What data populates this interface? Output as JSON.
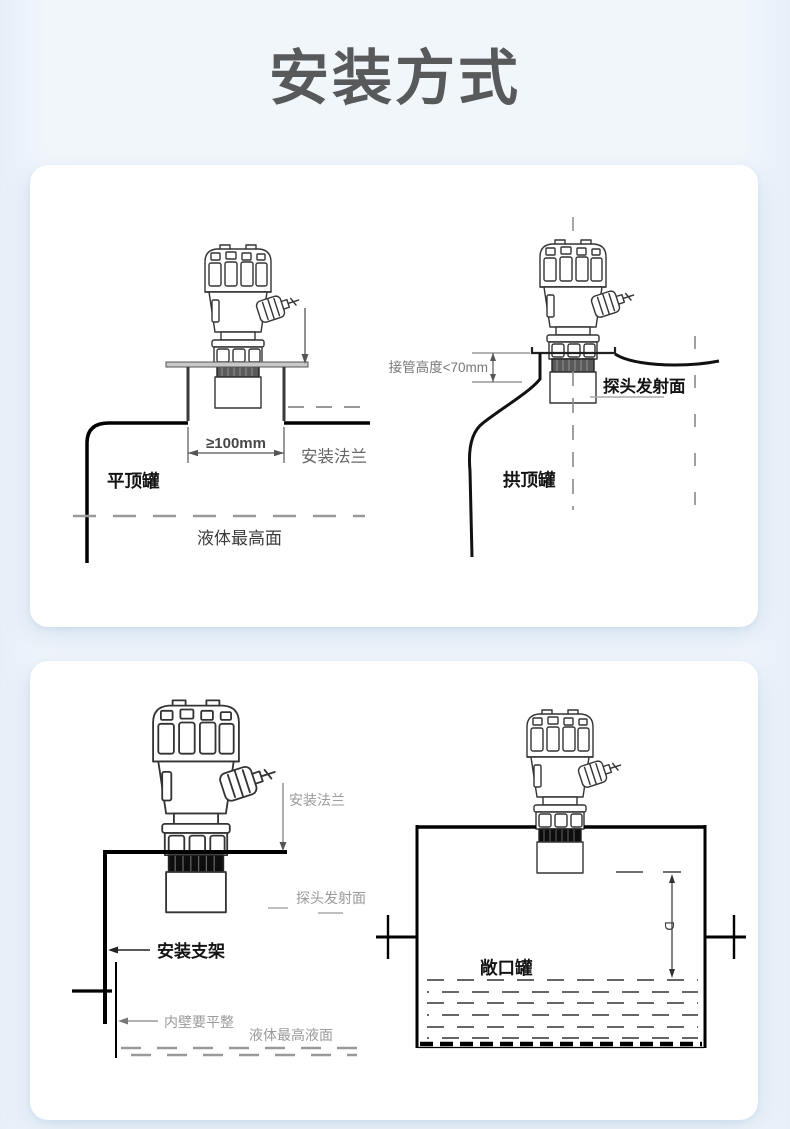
{
  "page": {
    "title": "安装方式"
  },
  "colors": {
    "background": "#f1f6fb",
    "panel": "#ffffff",
    "title": "#58595b",
    "line_black": "#111111",
    "line_gray": "#999999",
    "band_top_sensors": "#5a5a5a",
    "band_bottom_sensors": "#0d0d0d"
  },
  "panel_top": {
    "flat_tank": {
      "tank_label": "平顶罐",
      "opening_dim": "≥100mm",
      "flange_label": "安装法兰",
      "liquid_label": "液体最高面"
    },
    "dome_tank": {
      "nozzle_dim": "接管高度<70mm",
      "probe_label": "探头发射面",
      "tank_label": "拱顶罐"
    }
  },
  "panel_bottom": {
    "bracket_mount": {
      "flange_label": "安装法兰",
      "probe_label": "探头发射面",
      "bracket_label": "安装支架",
      "wall_label": "内壁要平整",
      "liquid_label": "液体最高液面"
    },
    "open_tank": {
      "tank_label": "敞口罐",
      "depth_dim": "D"
    }
  }
}
